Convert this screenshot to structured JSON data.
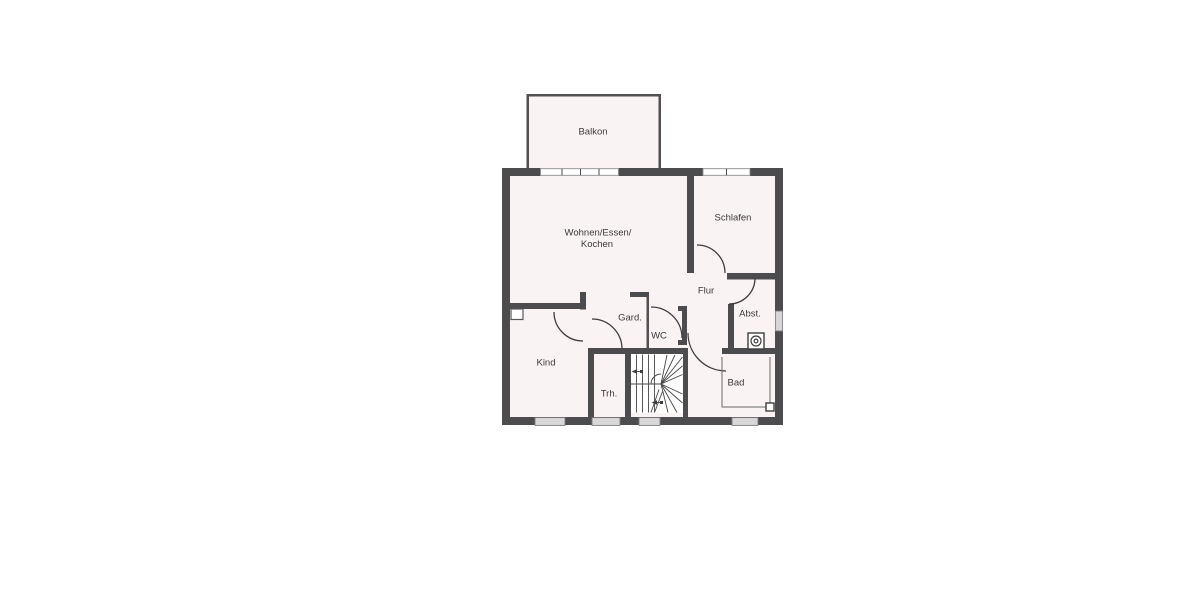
{
  "plan": {
    "type": "floor-plan",
    "language": "de",
    "rooms": [
      {
        "id": "balkon",
        "label": "Balkon"
      },
      {
        "id": "wohnen",
        "label": "Wohnen/Essen/",
        "label_line2": "Kochen"
      },
      {
        "id": "schlafen",
        "label": "Schlafen"
      },
      {
        "id": "flur",
        "label": "Flur"
      },
      {
        "id": "gard",
        "label": "Gard."
      },
      {
        "id": "wc",
        "label": "WC"
      },
      {
        "id": "abst",
        "label": "Abst."
      },
      {
        "id": "kind",
        "label": "Kind"
      },
      {
        "id": "trh",
        "label": "Trh."
      },
      {
        "id": "bad",
        "label": "Bad"
      }
    ],
    "fixtures": [
      {
        "name": "washing-machine-icon",
        "room": "abst"
      },
      {
        "name": "radiator-icon",
        "room": "bad"
      },
      {
        "name": "winder-staircase",
        "room": "trh",
        "direction_arrows": 2
      }
    ],
    "windows": {
      "top_wall": 2,
      "bottom_wall": 4,
      "right_wall": 1
    }
  },
  "colors": {
    "background": "#ffffff",
    "wall": "#4c4c4e",
    "room_fill": "#faf3f3",
    "window_block": "#d8d8d8",
    "line": "#3d3d3f",
    "text": "#3a3a3c"
  }
}
